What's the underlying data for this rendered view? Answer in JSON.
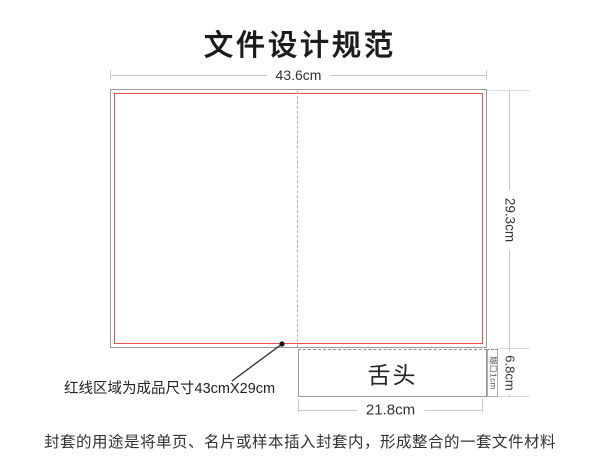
{
  "title": "文件设计规范",
  "diagram": {
    "top_dimension": "43.6cm",
    "right_dimension": "29.3cm",
    "tongue_label": "舌头",
    "tongue_width_dimension": "21.8cm",
    "tongue_height_dimension": "6.8cm",
    "glue_strip_label": "糊口1cm",
    "annotation": "红线区域为成品尺寸43cmX29cm"
  },
  "caption": "封套的用途是将单页、名片或样本插入封套内，形成整合的一套文件材料",
  "colors": {
    "finished_line": "#f0504c",
    "outline": "#9a9a9a",
    "dimension": "#c9c9c9",
    "fold_dash": "#b3b3b3",
    "text": "#333333"
  }
}
